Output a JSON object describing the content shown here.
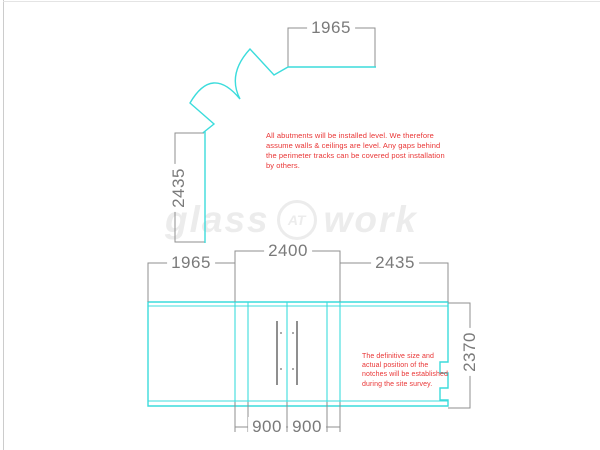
{
  "watermark": {
    "word1": "glass",
    "badge": "AT",
    "word2": "work"
  },
  "plan": {
    "width_label": "1965",
    "height_label": "2435"
  },
  "elevation": {
    "segment_labels": [
      "1965",
      "2400",
      "2435"
    ],
    "door_labels": [
      "900",
      "900"
    ],
    "height_label": "2370"
  },
  "notes": {
    "level_note": "All abutments will be installed level. We therefore\nassume walls & ceilings are level. Any gaps behind\nthe perimeter tracks can be covered post installation\nby others.",
    "notch_note": "The definitive size and\nactual position of the\nnotches will be established\nduring the site survey."
  },
  "colors": {
    "glass": "#3cdcdc",
    "dim": "#8f8f8f",
    "dimtext": "#7a7a7a",
    "note": "#e93535",
    "wm": "#ececec"
  }
}
